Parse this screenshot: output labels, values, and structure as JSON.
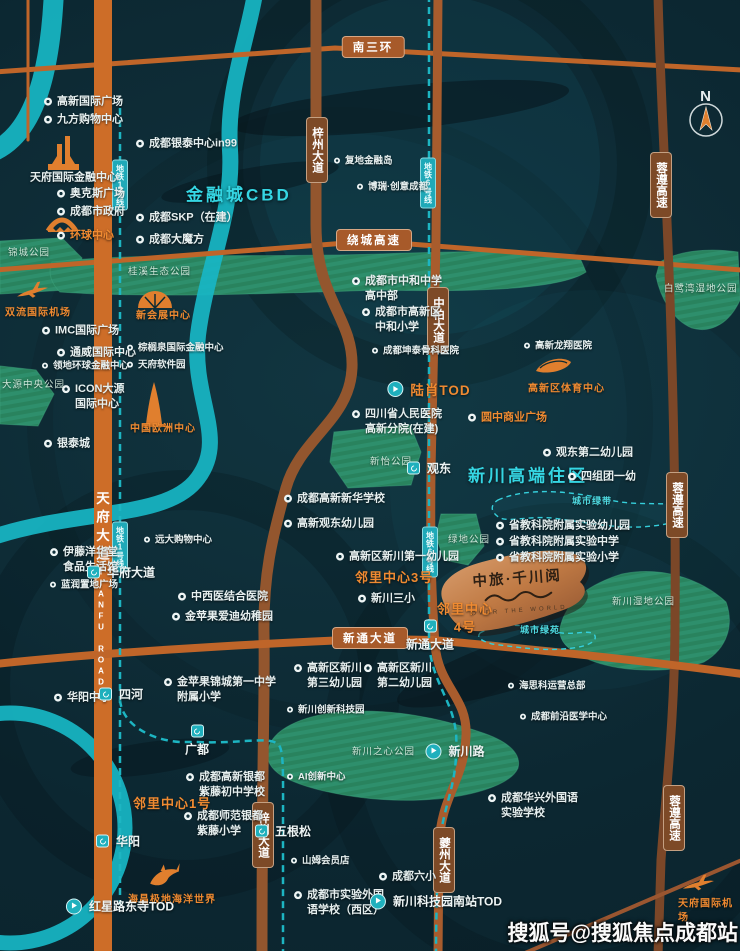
{
  "map": {
    "compass_n": "N",
    "watermark": "搜狐号@搜狐焦点成都站",
    "logo": {
      "title": "中旅·千川阅",
      "subtitle": "OVER THE WORLD"
    },
    "colors": {
      "background": "#0c2731",
      "river": "#18b6c4",
      "park": "#2e8f6c",
      "road_major": "#c2672a",
      "road_expressway": "#7b4728",
      "metro": "#1db5c2",
      "accent_orange": "#ef8a31",
      "accent_teal": "#35d6e3",
      "logo_bronze": "#c07a44"
    },
    "icons": [
      "ifs-towers-icon",
      "global-center-arch-icon",
      "shuangliu-airport-plane-icon",
      "expo-center-icon",
      "europe-center-tower-icon",
      "sports-center-stadium-icon",
      "dolphin-icon",
      "tianfu-airport-plane-icon",
      "compass-icon",
      "poi-marker-icon",
      "metro-station-marker"
    ],
    "road_pills": [
      {
        "label": "南三环",
        "x": 373,
        "y": 47,
        "orient": "h"
      },
      {
        "label": "绕城高速",
        "x": 374,
        "y": 240,
        "orient": "h"
      },
      {
        "label": "新通大道",
        "x": 370,
        "y": 638,
        "orient": "h"
      },
      {
        "label": "梓州大道",
        "x": 317,
        "y": 150,
        "orient": "v"
      },
      {
        "label": "梓州大道",
        "x": 263,
        "y": 835,
        "orient": "v"
      },
      {
        "label": "中柏大道",
        "x": 438,
        "y": 320,
        "orient": "v"
      },
      {
        "label": "夔州大道",
        "x": 444,
        "y": 860,
        "orient": "v"
      },
      {
        "label": "蓉遵高速",
        "x": 661,
        "y": 185,
        "orient": "v"
      },
      {
        "label": "蓉遵高速",
        "x": 677,
        "y": 505,
        "orient": "v"
      },
      {
        "label": "蓉遵高速",
        "x": 674,
        "y": 818,
        "orient": "v"
      }
    ],
    "metro_badges": [
      {
        "label": "地铁1号线",
        "x": 120,
        "y": 185
      },
      {
        "label": "地铁1号线",
        "x": 120,
        "y": 547
      },
      {
        "label": "地铁6号线",
        "x": 428,
        "y": 183
      },
      {
        "label": "地铁6号线",
        "x": 430,
        "y": 552
      }
    ],
    "onroad": [
      {
        "label": "天府大道",
        "x": 101,
        "y": 528,
        "cls": ""
      },
      {
        "label": "TIANFU ROAD",
        "x": 101,
        "y": 628,
        "cls": "en"
      }
    ],
    "stations": [
      {
        "label": "华府大道",
        "x": 121,
        "y": 572,
        "shape": "sq"
      },
      {
        "label": "四河",
        "x": 121,
        "y": 694,
        "shape": "sq"
      },
      {
        "label": "广都",
        "x": 197,
        "y": 741,
        "shape": "sq",
        "lpos": "below"
      },
      {
        "label": "华阳",
        "x": 118,
        "y": 841,
        "shape": "sq"
      },
      {
        "label": "红星路东寺TOD",
        "x": 120,
        "y": 906,
        "shape": "circ"
      },
      {
        "label": "五根松",
        "x": 283,
        "y": 831,
        "shape": "sq"
      },
      {
        "label": "观东",
        "x": 429,
        "y": 468,
        "shape": "sq"
      },
      {
        "label": "新通大道",
        "x": 430,
        "y": 636,
        "shape": "sq",
        "lpos": "below"
      },
      {
        "label": "新川路",
        "x": 455,
        "y": 751,
        "shape": "circ"
      },
      {
        "label": "新川科技园南站TOD",
        "x": 436,
        "y": 901,
        "shape": "circ"
      },
      {
        "label": "陆肖TOD",
        "x": 429,
        "y": 389,
        "shape": "circ",
        "cls": "big-orange"
      }
    ],
    "pois": [
      {
        "label": "高新国际广场",
        "x": 44,
        "y": 102
      },
      {
        "label": "九方购物中心",
        "x": 44,
        "y": 120
      },
      {
        "label": "天府国际金融中心",
        "x": 30,
        "y": 178,
        "marker": false
      },
      {
        "label": "奥克斯广场",
        "x": 57,
        "y": 194
      },
      {
        "label": "成都市政府",
        "x": 57,
        "y": 212
      },
      {
        "label": "环球中心",
        "x": 57,
        "y": 236,
        "cls": "orange"
      },
      {
        "label": "成都银泰中心in99",
        "x": 136,
        "y": 144
      },
      {
        "label": "金融城CBD",
        "x": 186,
        "y": 196,
        "cls": "area",
        "marker": false
      },
      {
        "label": "成都SKP（在建）",
        "x": 136,
        "y": 218
      },
      {
        "label": "成都大魔方",
        "x": 136,
        "y": 240
      },
      {
        "label": "锦城公园",
        "x": 8,
        "y": 254,
        "cls": "park",
        "marker": false
      },
      {
        "label": "桂溪生态公园",
        "x": 128,
        "y": 273,
        "cls": "park",
        "marker": false
      },
      {
        "label": "双流国际机场",
        "x": 5,
        "y": 313,
        "cls": "lm",
        "marker": false
      },
      {
        "label": "新会展中心",
        "x": 136,
        "y": 316,
        "cls": "lm",
        "marker": false
      },
      {
        "label": "IMC国际广场",
        "x": 42,
        "y": 331
      },
      {
        "label": "通威国际中心",
        "x": 57,
        "y": 353
      },
      {
        "label": "棕榈泉国际金融中心",
        "x": 127,
        "y": 349,
        "cls": "sm"
      },
      {
        "label": "领地环球金融中心",
        "x": 42,
        "y": 367,
        "cls": "sm"
      },
      {
        "label": "天府软件园",
        "x": 127,
        "y": 366,
        "cls": "sm"
      },
      {
        "label": "大源中央公园",
        "x": 2,
        "y": 386,
        "cls": "park",
        "marker": false
      },
      {
        "label": "ICON大源\n国际中心",
        "x": 62,
        "y": 397
      },
      {
        "label": "中国欧洲中心",
        "x": 130,
        "y": 429,
        "cls": "lm",
        "marker": false
      },
      {
        "label": "银泰城",
        "x": 44,
        "y": 444
      },
      {
        "label": "复地金融岛",
        "x": 334,
        "y": 162,
        "cls": "sm"
      },
      {
        "label": "博瑞·创意成都",
        "x": 357,
        "y": 188,
        "cls": "sm"
      },
      {
        "label": "成都市中和中学\n高中部",
        "x": 352,
        "y": 289
      },
      {
        "label": "成都市高新区\n中和小学",
        "x": 362,
        "y": 320
      },
      {
        "label": "成都坤泰骨科医院",
        "x": 372,
        "y": 352,
        "cls": "sm"
      },
      {
        "label": "四川省人民医院\n高新分院(在建)",
        "x": 352,
        "y": 422
      },
      {
        "label": "高新龙翔医院",
        "x": 524,
        "y": 347,
        "cls": "sm"
      },
      {
        "label": "高新区体育中心",
        "x": 528,
        "y": 389,
        "cls": "lm",
        "marker": false
      },
      {
        "label": "圆中商业广场",
        "x": 468,
        "y": 418,
        "cls": "orange"
      },
      {
        "label": "白鹭湾湿地公园",
        "x": 664,
        "y": 290,
        "cls": "park",
        "marker": false
      },
      {
        "label": "观东第二幼儿园",
        "x": 543,
        "y": 453
      },
      {
        "label": "新川高端住区",
        "x": 468,
        "y": 477,
        "cls": "area",
        "marker": false
      },
      {
        "label": "四组团一幼",
        "x": 568,
        "y": 477
      },
      {
        "label": "城市绿带",
        "x": 572,
        "y": 501,
        "cls": "green-tag",
        "marker": false
      },
      {
        "label": "省教科院附属实验幼儿园",
        "x": 496,
        "y": 526
      },
      {
        "label": "省教科院附属实验中学",
        "x": 496,
        "y": 542
      },
      {
        "label": "省教科院附属实验小学",
        "x": 496,
        "y": 558
      },
      {
        "label": "新怡公园",
        "x": 370,
        "y": 463,
        "cls": "park",
        "marker": false
      },
      {
        "label": "成都高新新华学校",
        "x": 284,
        "y": 499
      },
      {
        "label": "高新观东幼儿园",
        "x": 284,
        "y": 524
      },
      {
        "label": "绿地公园",
        "x": 448,
        "y": 541,
        "cls": "park",
        "marker": false
      },
      {
        "label": "高新区新川第一幼儿园",
        "x": 336,
        "y": 557
      },
      {
        "label": "邻里中心3号",
        "x": 355,
        "y": 578,
        "cls": "orange-big",
        "marker": false
      },
      {
        "label": "新川三小",
        "x": 358,
        "y": 599
      },
      {
        "label": "邻里中心\n4号",
        "x": 437,
        "y": 618,
        "cls": "orange-big center",
        "marker": false
      },
      {
        "label": "新川湿地公园",
        "x": 612,
        "y": 603,
        "cls": "park",
        "marker": false
      },
      {
        "label": "城市绿苑",
        "x": 520,
        "y": 630,
        "cls": "green-tag",
        "marker": false
      },
      {
        "label": "高新区新川\n第三幼儿园",
        "x": 294,
        "y": 676
      },
      {
        "label": "高新区新川\n第二幼儿园",
        "x": 364,
        "y": 676
      },
      {
        "label": "新川创新科技园",
        "x": 287,
        "y": 711,
        "cls": "sm"
      },
      {
        "label": "海思科运营总部",
        "x": 508,
        "y": 687,
        "cls": "sm"
      },
      {
        "label": "成都前沿医学中心",
        "x": 520,
        "y": 718,
        "cls": "sm"
      },
      {
        "label": "新川之心公园",
        "x": 352,
        "y": 753,
        "cls": "park",
        "marker": false
      },
      {
        "label": "AI创新中心",
        "x": 287,
        "y": 778,
        "cls": "sm"
      },
      {
        "label": "成都华兴外国语\n实验学校",
        "x": 488,
        "y": 806
      },
      {
        "label": "成都高新银都\n紫藤初中学校",
        "x": 186,
        "y": 785
      },
      {
        "label": "邻里中心1号",
        "x": 133,
        "y": 804,
        "cls": "orange-big",
        "marker": false
      },
      {
        "label": "成都师范银都\n紫藤小学",
        "x": 184,
        "y": 824
      },
      {
        "label": "伊藤洋华堂\n食品生活馆",
        "x": 50,
        "y": 560
      },
      {
        "label": "远大购物中心",
        "x": 144,
        "y": 541,
        "cls": "sm"
      },
      {
        "label": "蓝润置地广场",
        "x": 50,
        "y": 586,
        "cls": "sm"
      },
      {
        "label": "中西医结合医院",
        "x": 178,
        "y": 597
      },
      {
        "label": "金苹果爱迪幼稚园",
        "x": 172,
        "y": 617
      },
      {
        "label": "华阳中学",
        "x": 54,
        "y": 698
      },
      {
        "label": "金苹果锦城第一中学\n附属小学",
        "x": 164,
        "y": 690
      },
      {
        "label": "山姆会员店",
        "x": 291,
        "y": 862,
        "cls": "sm"
      },
      {
        "label": "成都六小",
        "x": 379,
        "y": 877
      },
      {
        "label": "成都市实验外国\n语学校（西区）",
        "x": 294,
        "y": 903
      },
      {
        "label": "海昌极地海洋世界",
        "x": 128,
        "y": 900,
        "cls": "lm",
        "marker": false
      },
      {
        "label": "天府国际机场",
        "x": 678,
        "y": 911,
        "cls": "lm",
        "marker": false
      }
    ]
  }
}
